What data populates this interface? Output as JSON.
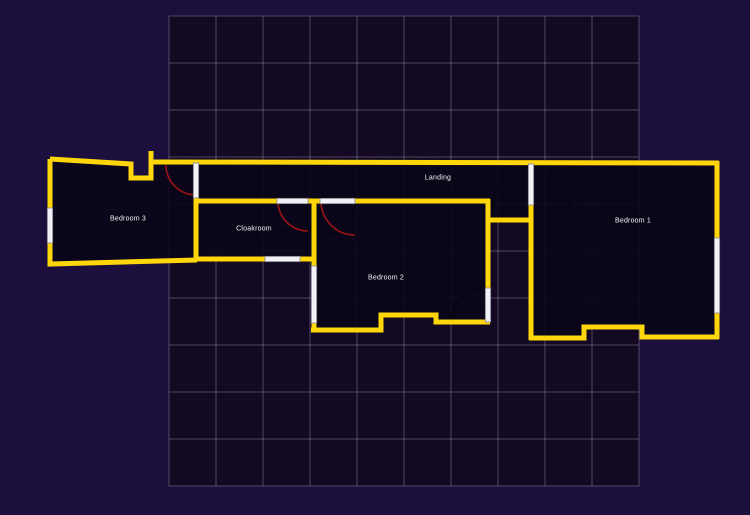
{
  "floor_plan": {
    "labels": {
      "bedroom3": "Bedroom 3",
      "cloakroom": "Cloakroom",
      "landing": "Landing",
      "bedroom2": "Bedroom 2",
      "bedroom1": "Bedroom 1"
    },
    "grid": {
      "cols": 10,
      "rows": 10,
      "cell_px": 47
    },
    "colors": {
      "page_background": "#1c0f3e",
      "grid_fill": "#130923",
      "grid_line": "#9a9ab0",
      "room_fill": "#0a0618",
      "wall": "#ffd60a",
      "door_swing": "#9b1414",
      "door_swing_dark": "#06040f",
      "opening_fill": "#f2f2f6",
      "label_text": "#f5f5fa"
    }
  }
}
